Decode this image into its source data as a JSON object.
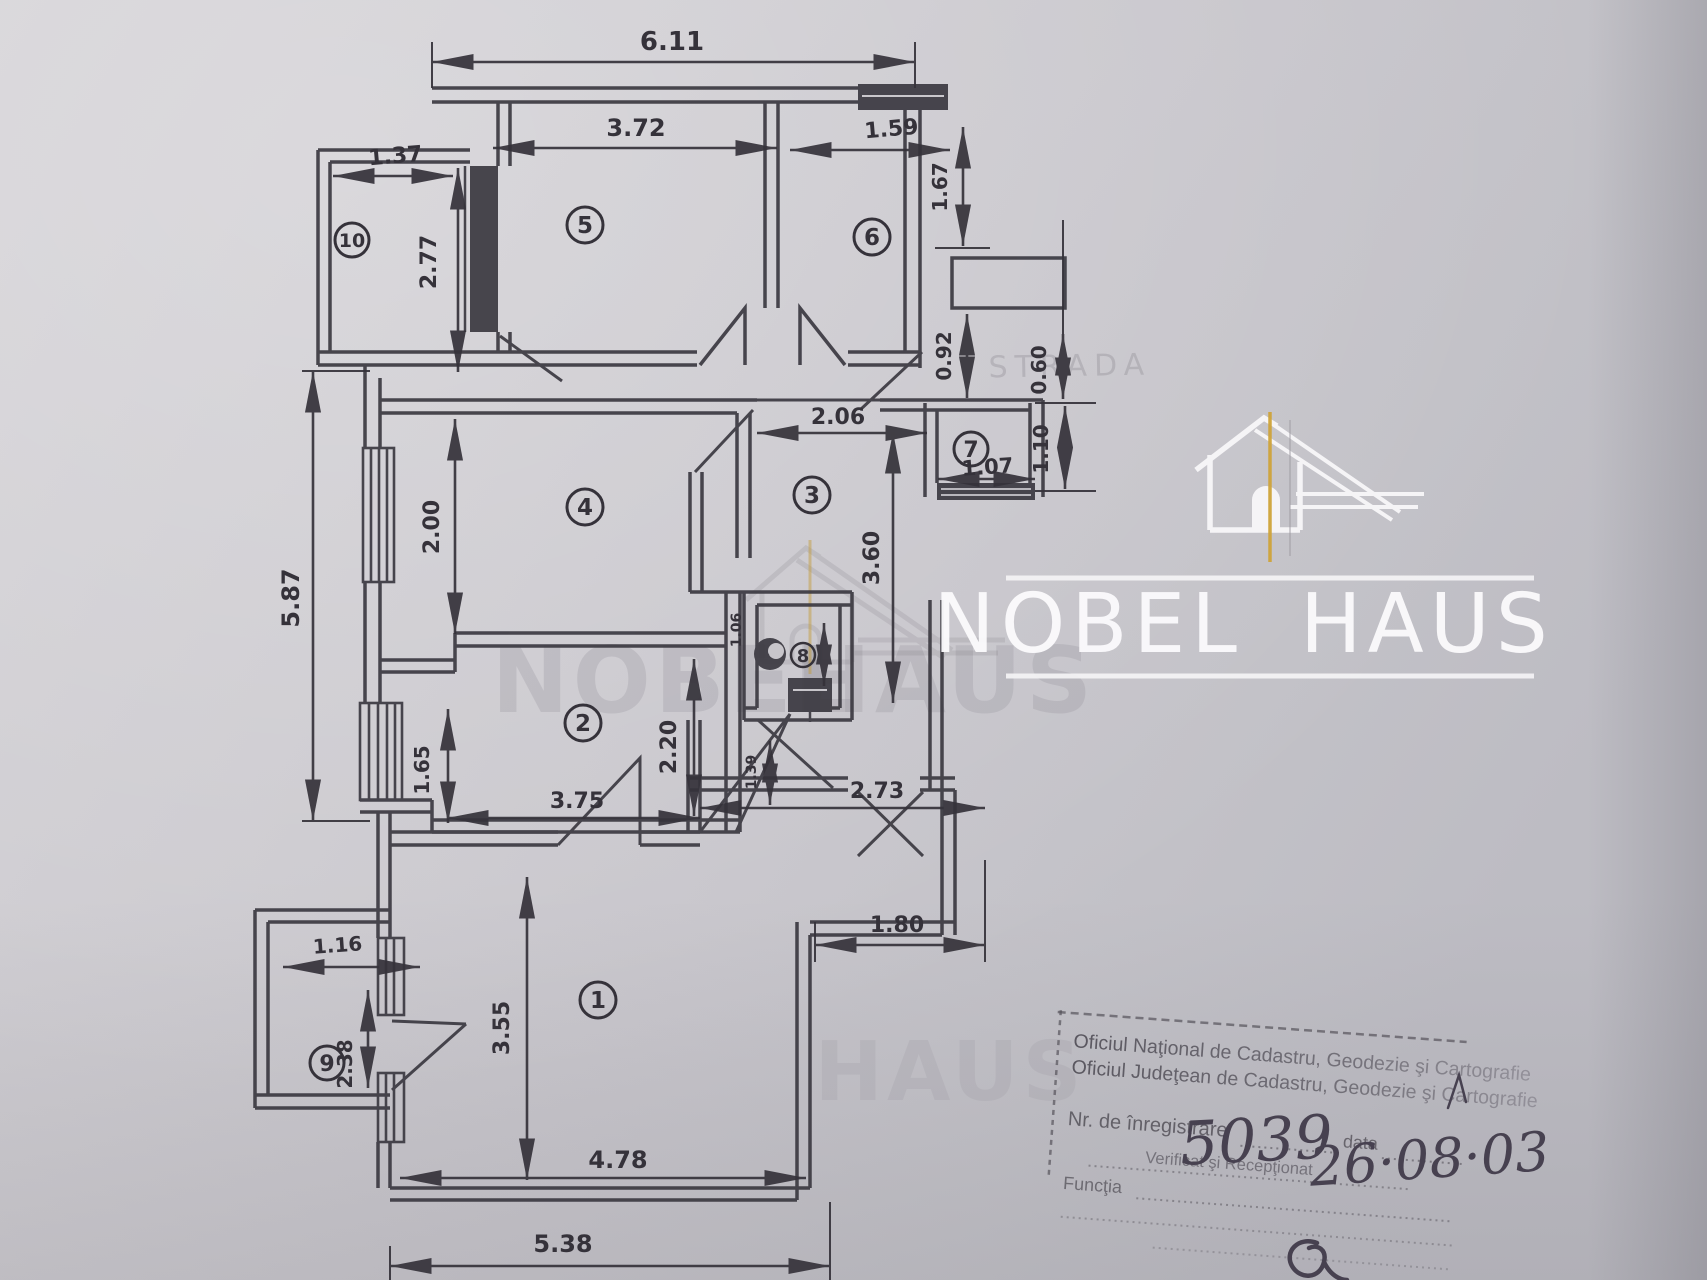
{
  "plan": {
    "room_numbers": [
      "1",
      "2",
      "3",
      "4",
      "5",
      "6",
      "7",
      "8",
      "9",
      "10"
    ],
    "dims": [
      "6.11",
      "3.72",
      "1.59",
      "1.37",
      "2.77",
      "1.67",
      "0.92",
      "0.60",
      "1.10",
      "2.06",
      "1.07",
      "2.00",
      "3.60",
      "5.87",
      "2.20",
      "1.65",
      "3.75",
      "1.06",
      "1.39",
      "2.73",
      "1.80",
      "1.16",
      "2.38",
      "3.55",
      "4.78",
      "5.38"
    ]
  },
  "watermark": {
    "brand_first": "NOBEL",
    "brand_second": "HAUS",
    "accent_color": "#cfa43a",
    "faint_first": "NOBEL",
    "faint_second": "HAUS",
    "faint_bottom": "HAUS",
    "faint_street": "STRADA"
  },
  "stamp": {
    "office_line1": "Oficiul Naţional de Cadastru, Geodezie şi Cartografie",
    "office_line2": "Oficiul Judeţean de Cadastru, Geodezie şi Cartografie",
    "registration_label": "Nr. de înregistrare",
    "registration_number": "5039",
    "date_label": "data",
    "date_value": "26·08·03",
    "verified_line": "Verificat şi Recepţionat",
    "function_label": "Funcţia"
  }
}
